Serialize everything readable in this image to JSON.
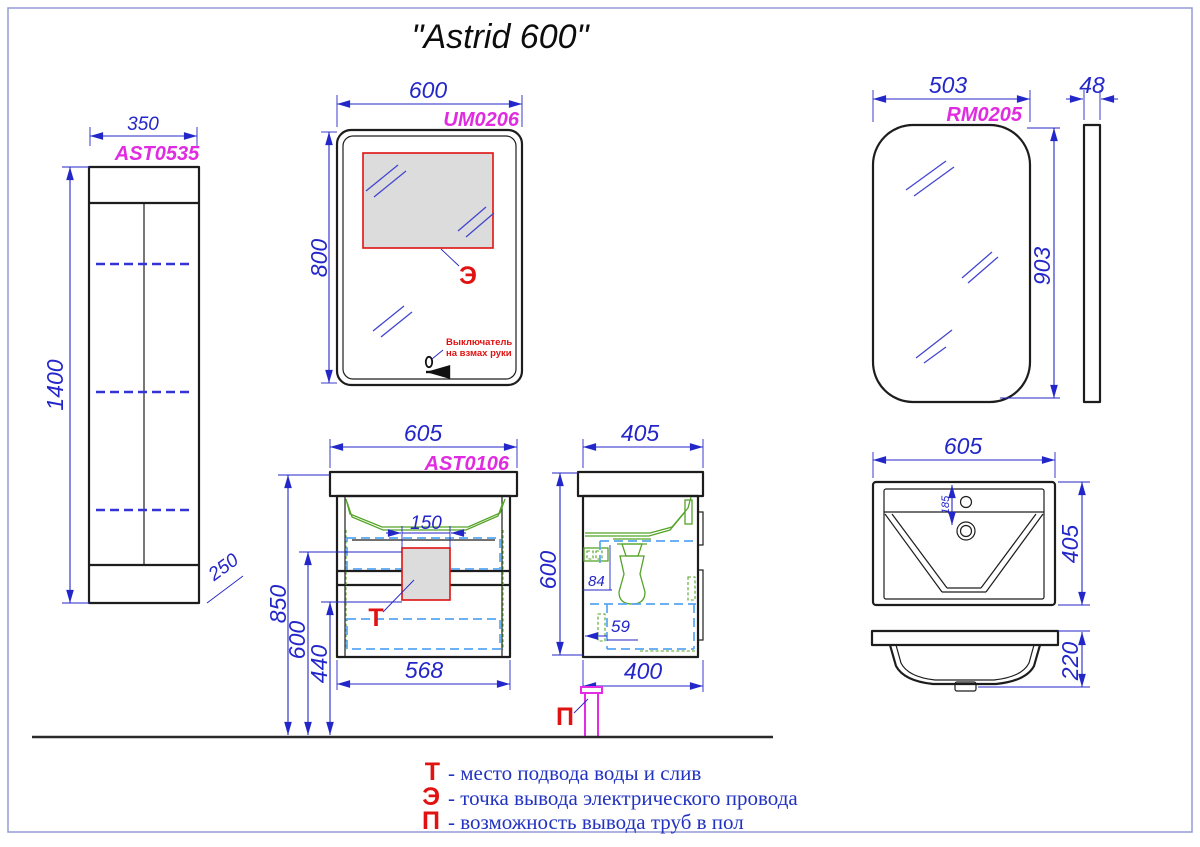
{
  "page": {
    "title": "\"Astrid 600\""
  },
  "views": {
    "tall_cabinet": {
      "code": "AST0535",
      "width_mm": "350",
      "height_mm": "1400",
      "depth_mm": "250"
    },
    "led_mirror": {
      "code": "UM0206",
      "width_mm": "600",
      "height_mm": "800",
      "electric_point_label": "Э",
      "switch_note_line1": "Выключатель",
      "switch_note_line2": "на взмах руки"
    },
    "plain_mirror": {
      "code": "RM0205",
      "width_mm": "503",
      "height_mm": "903",
      "depth_mm": "48"
    },
    "vanity_front": {
      "code": "AST0106",
      "width_mm": "605",
      "body_width_mm": "568",
      "cutout_width_mm": "150",
      "height_total_mm": "850",
      "height_water_mm": "600",
      "height_bottom_mm": "440",
      "water_point_label": "Т"
    },
    "vanity_side": {
      "depth_mm": "405",
      "height_mm": "600",
      "dim_84_mm": "84",
      "dim_59_mm": "59",
      "bottom_depth_mm": "400",
      "floor_pipe_label": "П"
    },
    "sink_top": {
      "width_mm": "605",
      "depth_mm": "405",
      "drain_offset_mm": "185"
    },
    "sink_front": {
      "height_mm": "220"
    }
  },
  "legend": {
    "items": [
      {
        "letter": "Т",
        "description": "- место подвода воды и слив"
      },
      {
        "letter": "Э",
        "description": "-  точка вывода электрического провода"
      },
      {
        "letter": "П",
        "description": "- возможность вывода труб в пол"
      }
    ]
  },
  "colors": {
    "dimension_blue": "#2326c8",
    "code_magenta": "#e02ce0",
    "annotation_red": "#e01212",
    "fixture_green": "#55a428",
    "drawer_dashed_blue": "#58a6f2",
    "shelf_dashed_blue": "#3434d6",
    "pipe_magenta": "#e42ce4"
  }
}
